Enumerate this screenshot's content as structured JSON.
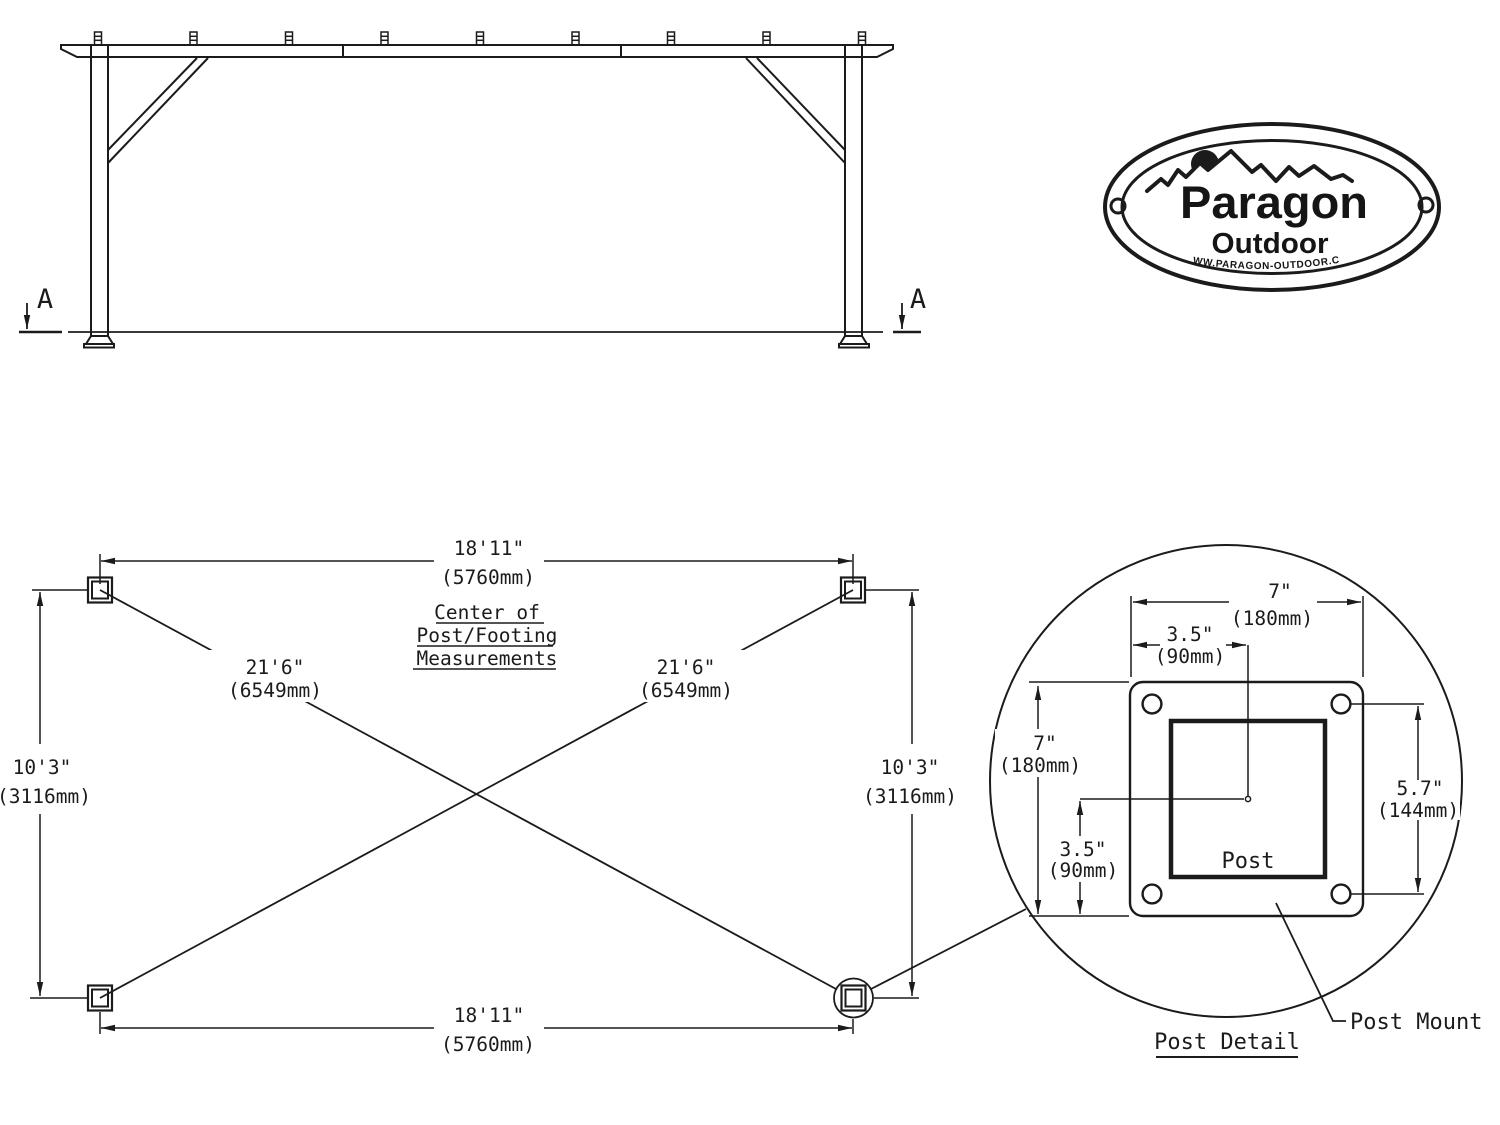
{
  "colors": {
    "line": "#1b1b1b",
    "background": "#ffffff"
  },
  "elevation": {
    "section_marker_left": "A",
    "section_marker_right": "A"
  },
  "logo": {
    "brand": "Paragon",
    "subtitle": "Outdoor",
    "website": "WWW.PARAGON-OUTDOOR.COM"
  },
  "plan": {
    "note_line1": "Center of",
    "note_line2": "Post/Footing",
    "note_line3": "Measurements",
    "top_dim_ft": "18'11\"",
    "top_dim_mm": "(5760mm)",
    "bottom_dim_ft": "18'11\"",
    "bottom_dim_mm": "(5760mm)",
    "left_dim_ft": "10'3\"",
    "left_dim_mm": "(3116mm)",
    "right_dim_ft": "10'3\"",
    "right_dim_mm": "(3116mm)",
    "diag_left_ft": "21'6\"",
    "diag_left_mm": "(6549mm)",
    "diag_right_ft": "21'6\"",
    "diag_right_mm": "(6549mm)"
  },
  "detail": {
    "title": "Post Detail",
    "post_label": "Post",
    "mount_label": "Post Mount",
    "plate_width_in": "7\"",
    "plate_width_mm": "(180mm)",
    "plate_half_width_in": "3.5\"",
    "plate_half_width_mm": "(90mm)",
    "plate_height_in": "7\"",
    "plate_height_mm": "(180mm)",
    "plate_half_height_in": "3.5\"",
    "plate_half_height_mm": "(90mm)",
    "bolt_spacing_in": "5.7\"",
    "bolt_spacing_mm": "(144mm)"
  }
}
